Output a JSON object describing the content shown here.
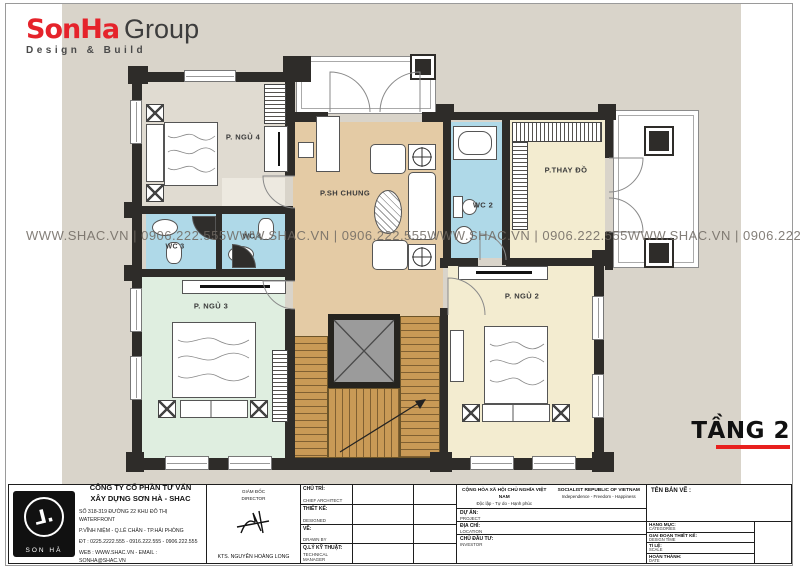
{
  "brand": {
    "logo_red": "SonHa",
    "logo_dark": "Group",
    "tagline": "Design & Build",
    "accent_red": "#E5232B"
  },
  "watermark": {
    "text": "WWW.SHAC.VN | 0906.222.555",
    "repeats": 4
  },
  "floor_plan": {
    "floor_label": "TẦNG 2",
    "rooms": [
      {
        "id": "bedroom4",
        "label": "P. NGỦ 4"
      },
      {
        "id": "living",
        "label": "P.SH CHUNG"
      },
      {
        "id": "dressing",
        "label": "P.THAY ĐỒ"
      },
      {
        "id": "wc2",
        "label": "WC 2"
      },
      {
        "id": "wc3",
        "label": "WC 3"
      },
      {
        "id": "wc4",
        "label": "WC 4"
      },
      {
        "id": "bedroom3",
        "label": "P. NGỦ 3"
      },
      {
        "id": "bedroom2",
        "label": "P. NGỦ 2"
      }
    ],
    "colors": {
      "wall": "#2e2c29",
      "canvas": "#D9D4CA",
      "living_floor": "#E4CBA5",
      "bedroom3_floor": "#DFEEE0",
      "bedroom2_floor": "#F3ECD0",
      "wc_floor": "#AFD9E8",
      "stairs": "#C99A56",
      "floor_tag_underline": "#E8201E"
    }
  },
  "title_block": {
    "company": {
      "logo_text": "SON HÀ",
      "name_line1": "CÔNG TY CỔ PHẦN TƯ VẤN",
      "name_line2": "XÂY DỰNG SƠN HÀ - SHAC",
      "address_line1": "SỐ 318-319 ĐƯỜNG 22 KHU ĐÔ THỊ WATERFRONT",
      "address_line2": "P.VĨNH NIỆM - Q.LÊ CHÂN - TP.HẢI PHÒNG",
      "phone_line": "ĐT : 0225.2222.555 - 0916.222.555 - 0906.222.555",
      "web_line": "WEB : WWW.SHAC.VN - EMAIL : SONHA@SHAC.VN"
    },
    "director": {
      "title_vi": "GIÁM ĐỐC",
      "title_en": "DIRECTOR",
      "name": "KTS. NGUYỄN HOÀNG LONG"
    },
    "roles": [
      {
        "vi": "CHỦ TRÌ:",
        "en": "CHIEF ARCHITECT"
      },
      {
        "vi": "THIẾT KẾ:",
        "en": "DESIGNED"
      },
      {
        "vi": "VẼ:",
        "en": "DRAWN BY"
      },
      {
        "vi": "Q.LÝ KỸ THUẬT:",
        "en": "TECHNICAL MANAGER"
      }
    ],
    "national": {
      "motto_vi_1": "CỘNG HÒA XÃ HỘI CHỦ NGHĨA VIỆT NAM",
      "motto_vi_2": "Độc lập - Tự do - Hạnh phúc",
      "motto_en_1": "SOCIALIST REPUBLIC OF VIETNAM",
      "motto_en_2": "Independence - Freedom - Happiness"
    },
    "project_rows": [
      {
        "vi": "DỰ ÁN:",
        "en": "PROJECT"
      },
      {
        "vi": "ĐỊA CHỈ:",
        "en": "LOCATION"
      },
      {
        "vi": "CHỦ ĐẦU TƯ:",
        "en": "INVESTOR"
      }
    ],
    "drawing": {
      "name_label": "TÊN BẢN VẼ :",
      "rows": [
        {
          "vi": "HẠNG MỤC:",
          "en": "CATEGORIES"
        },
        {
          "vi": "GIAI ĐOẠN THIẾT KẾ:",
          "en": "DESIGN TIME"
        },
        {
          "vi": "TỈ LỆ:",
          "en": "SCALE"
        },
        {
          "vi": "HOÀN THÀNH:",
          "en": "DATE"
        }
      ]
    }
  }
}
